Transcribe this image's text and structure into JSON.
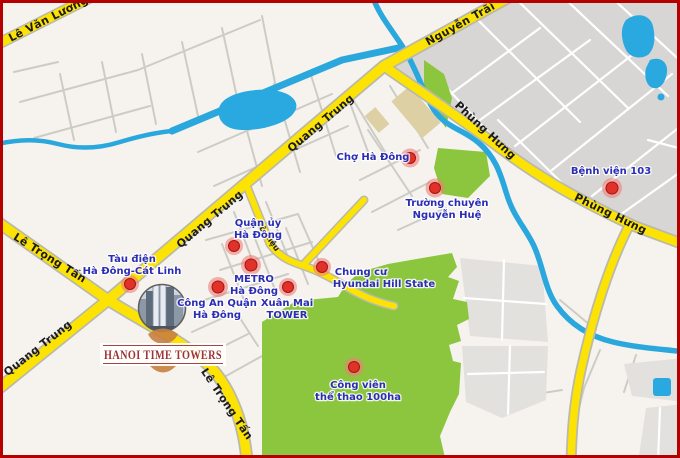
{
  "map": {
    "title": "Hanoi Time Towers location map",
    "roads": {
      "le_van_luong": "Lê Văn Lương",
      "nguyen_trai": "Nguyễn Trãi",
      "quang_trung": "Quang Trung",
      "phung_hung": "Phùng Hưng",
      "le_trong_tan": "Lê Trọng Tấn",
      "to_hieu": "Tô Hiệu"
    },
    "pois": {
      "cho_ha_dong": {
        "line1": "Chợ Hà Đông"
      },
      "benh_vien_103": {
        "line1": "Bệnh viện 103"
      },
      "truong_chuyen": {
        "line1": "Trường chuyên",
        "line2": "Nguyễn Huệ"
      },
      "quan_uy": {
        "line1": "Quận ủy",
        "line2": "Hà Đông"
      },
      "metro": {
        "line1": "METRO",
        "line2": "Hà Đông"
      },
      "cong_an": {
        "line1": "Công An Quận",
        "line2": "Hà Đông"
      },
      "xuan_mai": {
        "line1": "Xuân Mai",
        "line2": "TOWER"
      },
      "hyundai": {
        "line1": "Chung cư",
        "line2": "Hyundai Hill State"
      },
      "tau_dien": {
        "line1": "Tàu điện",
        "line2": "Hà Đông-Cát Linh"
      },
      "cong_vien": {
        "line1": "Công viên",
        "line2": "thể thao 100ha"
      }
    },
    "logo": {
      "title": "HANOI TIME TOWERS"
    },
    "colors": {
      "road_yellow": "#fce303",
      "water_blue": "#2aa7dd",
      "park_green": "#8cc63e",
      "marker_red": "#e03228",
      "poi_text_blue": "#2b2db4",
      "logo_red": "#9e3336",
      "border_red": "#b50000",
      "urban_gray": "#d7d6d4",
      "tan_block": "#ddd0a4"
    }
  }
}
